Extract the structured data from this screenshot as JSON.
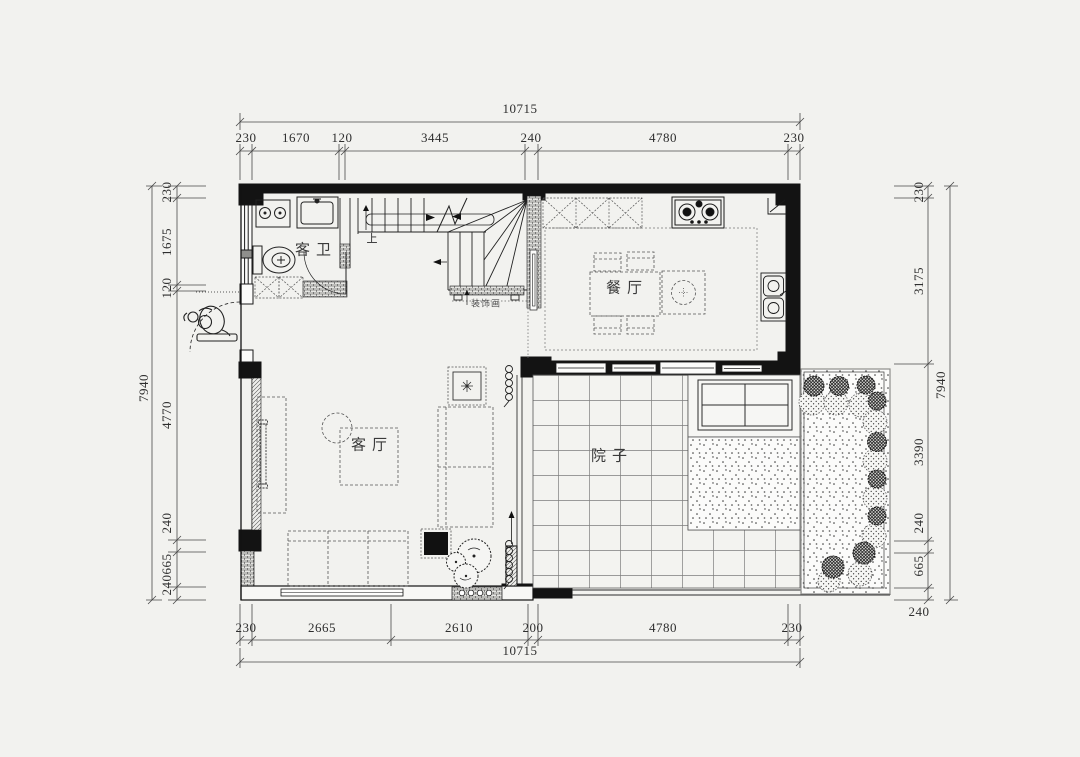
{
  "rooms": {
    "bathroom": "客卫",
    "dining": "餐厅",
    "living": "客厅",
    "courtyard": "院子"
  },
  "annotations": {
    "stairs_up": "上",
    "decor_cabinet": "装饰画"
  },
  "dimensions": {
    "top": {
      "total": "10715",
      "segments": [
        "230",
        "1670",
        "120",
        "3445",
        "240",
        "4780",
        "230"
      ]
    },
    "bottom": {
      "total": "10715",
      "segments": [
        "230",
        "2665",
        "2610",
        "200",
        "4780",
        "230"
      ]
    },
    "left": {
      "total": "7940",
      "segments": [
        "230",
        "1675",
        "120",
        "4770",
        "240",
        "665",
        "240"
      ]
    },
    "right": {
      "total": "7940",
      "segments": [
        "230",
        "3175",
        "3390",
        "240",
        "665",
        "240"
      ]
    }
  },
  "colors": {
    "background": "#f2f2ef",
    "wall": "#131313",
    "line": "#222222",
    "furniture_dash": "#555555",
    "dim_text": "#2e2e2e"
  }
}
